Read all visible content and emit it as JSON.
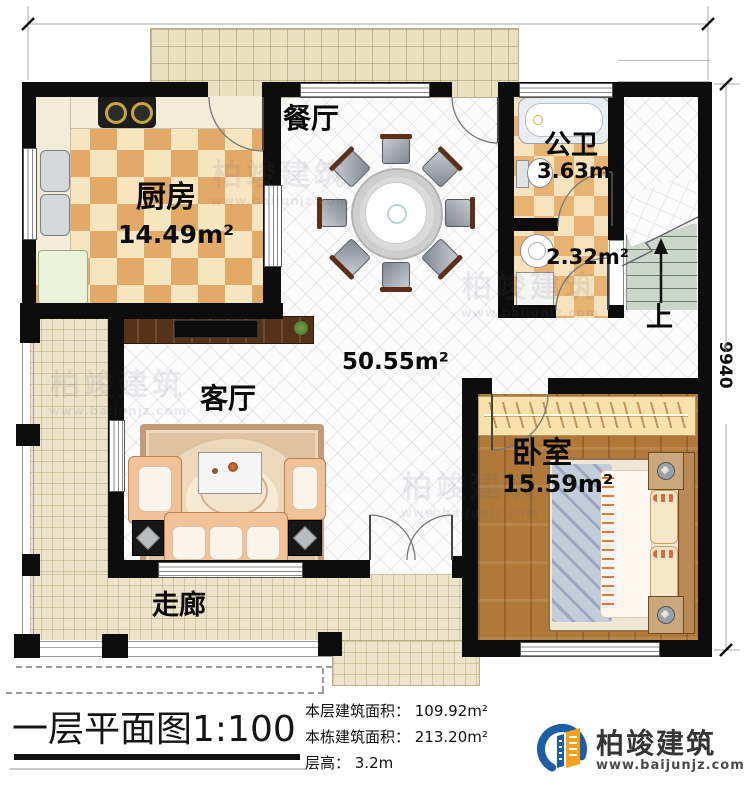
{
  "dimensions": {
    "top": "11940",
    "right": "9940"
  },
  "rooms": {
    "dining": {
      "label": "餐厅"
    },
    "kitchen": {
      "label": "厨房",
      "area": "14.49m²"
    },
    "public_bath": {
      "label": "公卫",
      "area": "3.63m²"
    },
    "laundry": {
      "area": "2.32m²"
    },
    "open_area": {
      "area": "50.55m²"
    },
    "living": {
      "label": "客厅"
    },
    "bedroom": {
      "label": "卧室",
      "area": "15.59m²"
    },
    "corridor": {
      "label": "走廊"
    },
    "stair": {
      "up_label": "上"
    }
  },
  "title_block": {
    "title": "一层平面图",
    "scale": "1:100",
    "stats": [
      "本层建筑面积： 109.92m²",
      "本栋建筑面积： 213.20m²",
      "层高： 3.2m"
    ]
  },
  "logo": {
    "name": "柏竣建筑",
    "website": "www.baijunjz.com"
  },
  "watermark": {
    "name": "柏竣建筑",
    "website": "www.baijunjz.com"
  },
  "colors": {
    "wall": "#0d0d0d",
    "kitchen_tile_dark": "#e3aa67",
    "kitchen_tile_light": "#f7e5c0",
    "wood_floor": "#b0793a",
    "corridor_tile": "#ebe4ca",
    "logo_blue": "#1b5ea7",
    "logo_orange": "#f4a11d"
  }
}
